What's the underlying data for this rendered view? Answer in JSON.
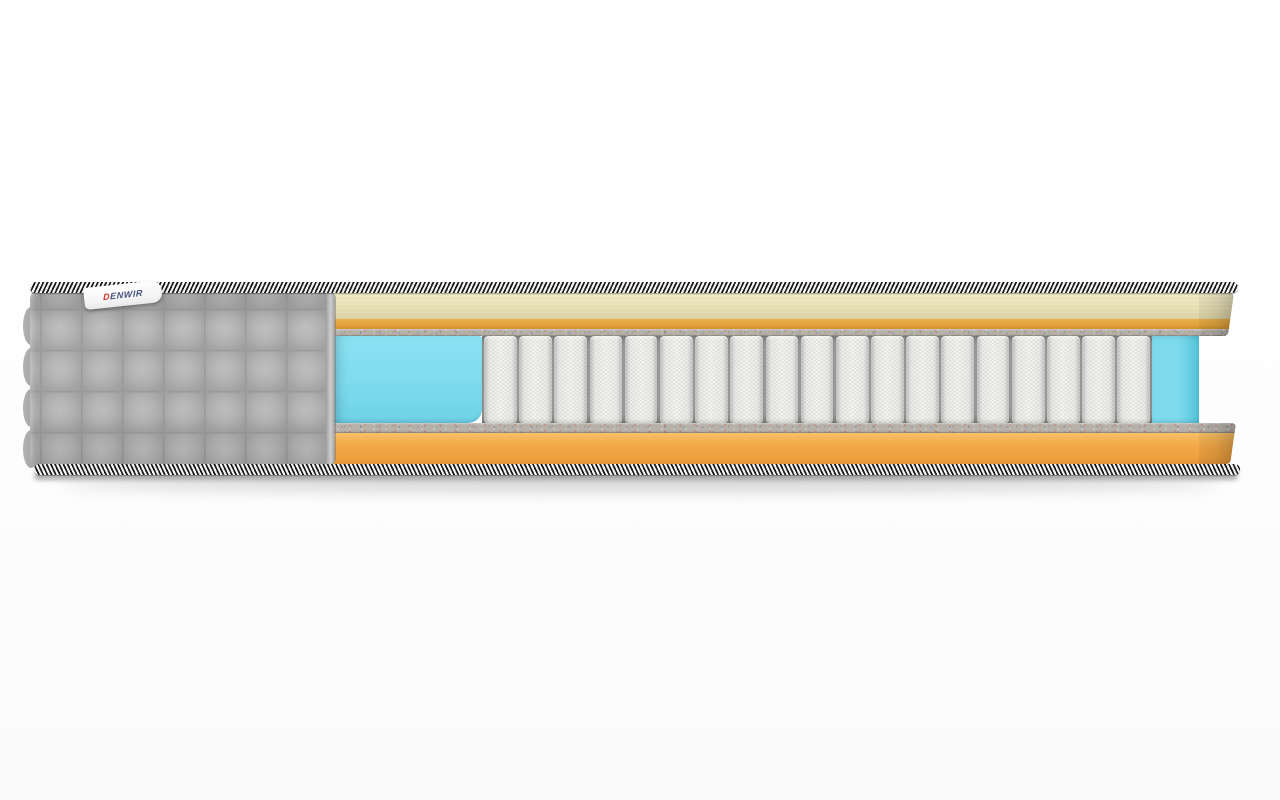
{
  "scene": {
    "description": "Cutaway 3D product render of a pocket-spring mattress, side view on a white studio background with a soft floor shadow"
  },
  "brand_label": {
    "text": "DENWIR"
  },
  "springs": {
    "count": 19
  },
  "construction_layers": [
    "gray quilted fabric cover (left, with scalloped edge)",
    "black-and-white braided edge piping (top and bottom)",
    "cream quilted comfort layer",
    "thin orange foam strip",
    "speckled felt pad (top)",
    "cyan foam side block (left of springs)",
    "white pocketed spring coils",
    "cyan foam side block (right of springs)",
    "speckled felt pad (bottom)",
    "orange base foam layer"
  ],
  "colors": {
    "quilt_gray": "#a9a9a9",
    "cream": "#e9e0b6",
    "orange_strip": "#e2a23c",
    "felt_gray": "#b6b1a9",
    "foam_blue": "#7edbee",
    "coil_white": "#f5f5f3",
    "base_orange": "#f3ab49",
    "piping_dark": "#1a1a1a",
    "piping_light": "#f2f2f2",
    "background": "#fdfdfd"
  }
}
